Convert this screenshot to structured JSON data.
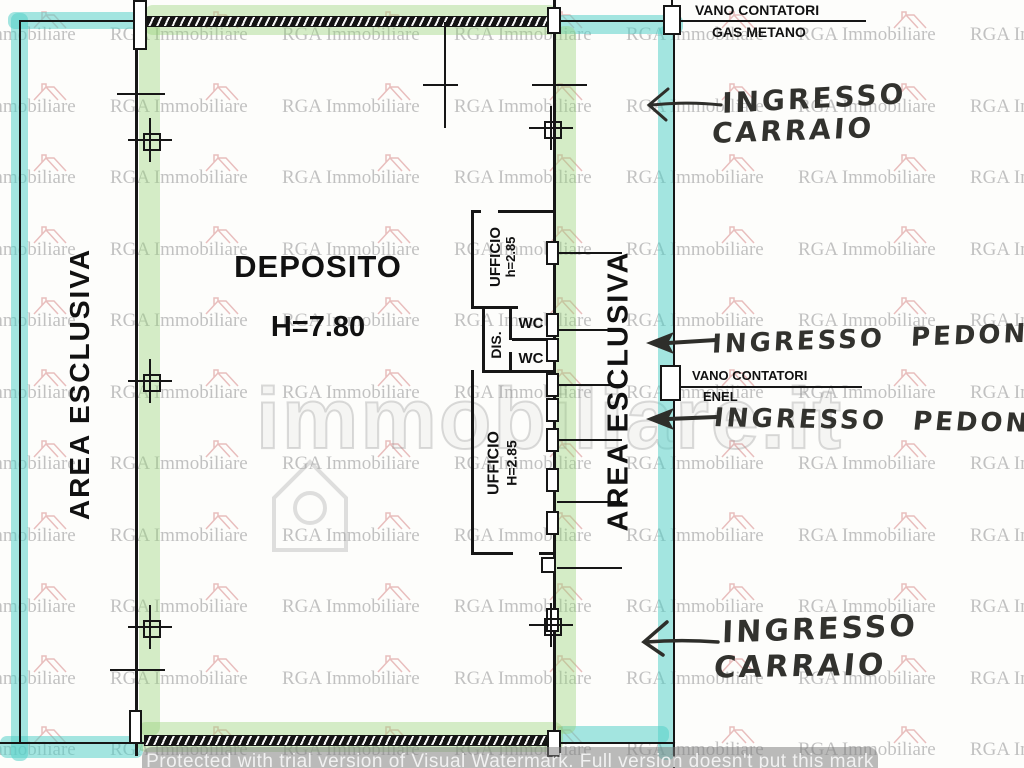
{
  "watermark": {
    "brand": "RGA Immobiliare",
    "big_text": "immobiliare.it",
    "protected_notice": "Protected with trial version of Visual Watermark. Full version doesn't put this mark"
  },
  "floorplan": {
    "deposito": {
      "name": "DEPOSITO",
      "height": "H=7.80"
    },
    "ufficio_upper": {
      "name": "UFFICIO",
      "height": "h=2.85"
    },
    "ufficio_lower": {
      "name": "UFFICIO",
      "height": "H=2.85"
    },
    "dis_label": "DIS.",
    "wc_upper": "WC",
    "wc_lower": "WC",
    "area_esclusiva_left": "AREA ESCLUSIVA",
    "area_esclusiva_right": "AREA ESCLUSIVA",
    "vano_gas": {
      "line1": "VANO CONTATORI",
      "line2": "GAS METANO"
    },
    "vano_enel": {
      "line1": "VANO CONTATORI",
      "line2": "ENEL"
    },
    "ingresso_carraio_top": {
      "line1": "INGRESSO",
      "line2": "CARRAIO"
    },
    "ingresso_pedoni_upper": "INGRESSO PEDONI",
    "ingresso_pedoni_lower": "INGRESSO PEDONI",
    "ingresso_carraio_bottom": {
      "line1": "INGRESSO",
      "line2": "CARRAIO"
    }
  },
  "colors": {
    "highlight_cyan": "#50cfc7",
    "highlight_green": "#97d179",
    "wall": "#161616",
    "watermark_gray": "#b3b3b3",
    "watermark_house_pink": "#e2a9a9",
    "handwriting": "#32322e"
  }
}
